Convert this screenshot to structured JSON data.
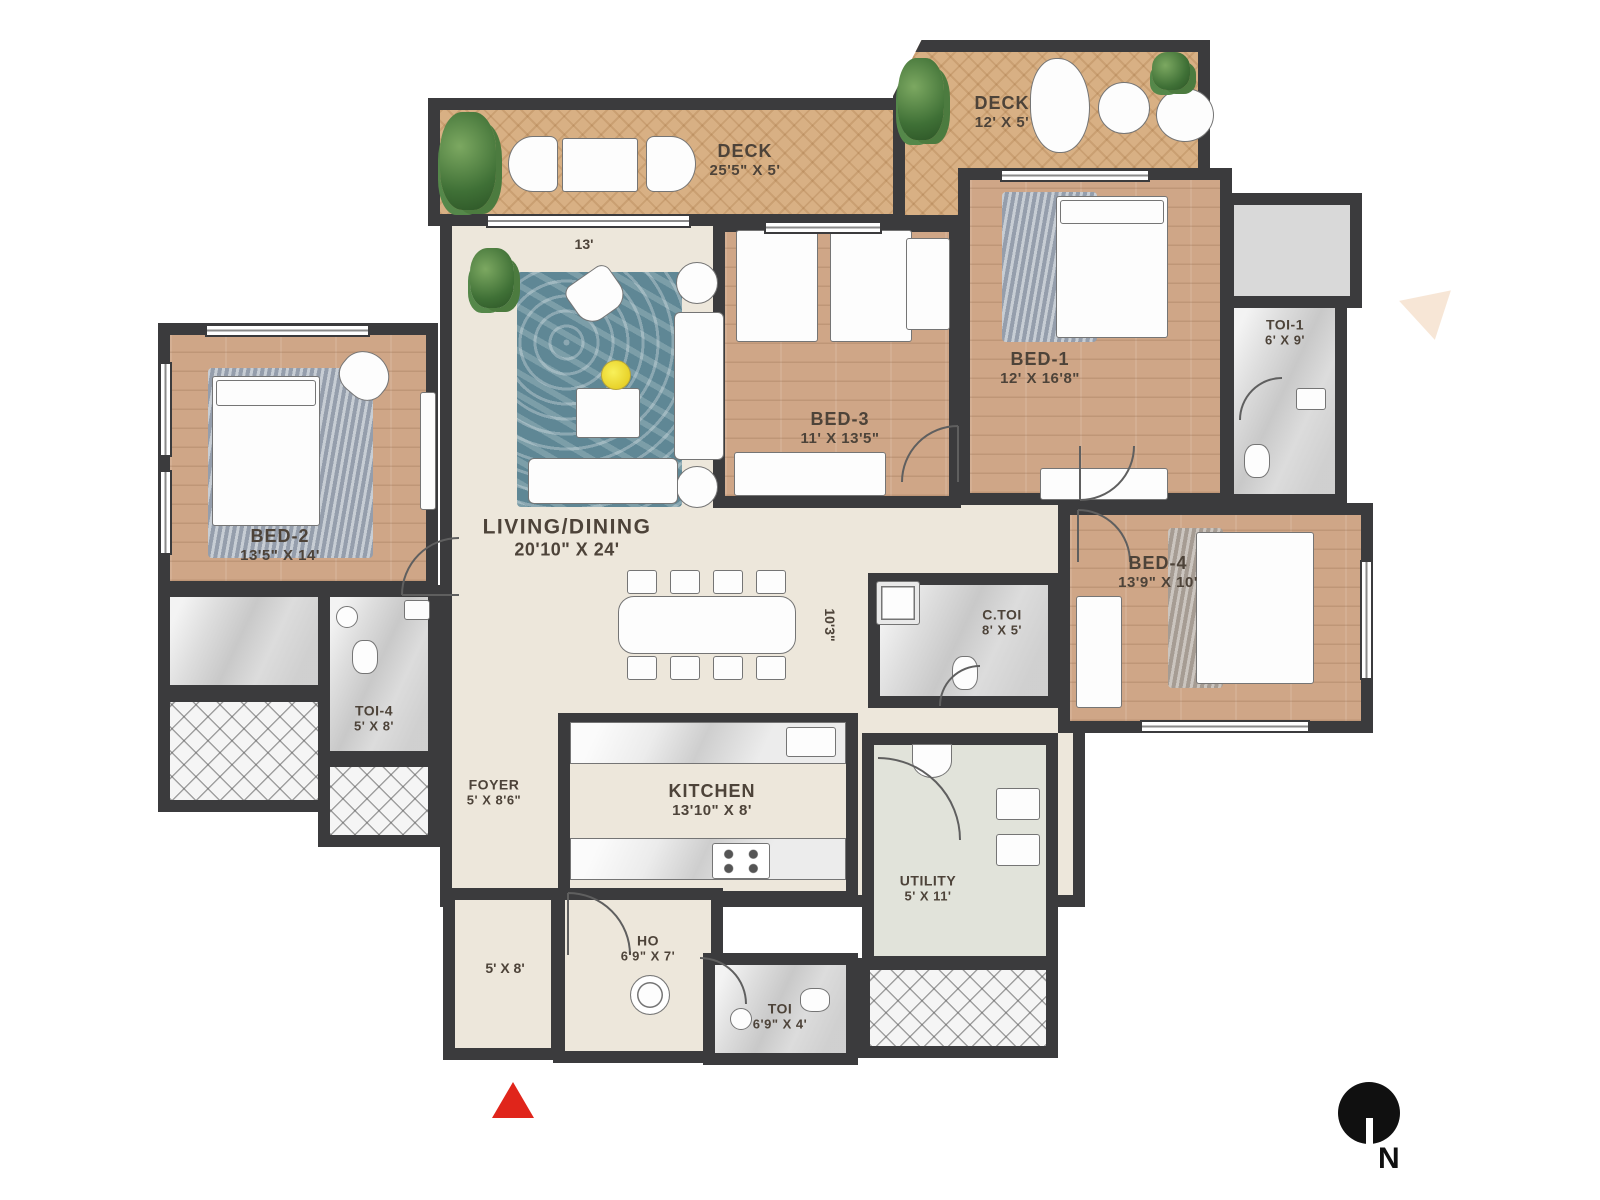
{
  "plan": {
    "rooms": {
      "deck_main": {
        "name": "DECK",
        "dims": "25'5\" X 5'"
      },
      "deck_2": {
        "name": "DECK",
        "dims": "12' X 5'"
      },
      "living": {
        "name": "LIVING/DINING",
        "dims": "20'10\" X 24'"
      },
      "bed1": {
        "name": "BED-1",
        "dims": "12' X 16'8\""
      },
      "toi1": {
        "name": "TOI-1",
        "dims": "6' X 9'"
      },
      "bed3": {
        "name": "BED-3",
        "dims": "11' X 13'5\""
      },
      "bed2": {
        "name": "BED-2",
        "dims": "13'5\" X 14'"
      },
      "toi4": {
        "name": "TOI-4",
        "dims": "5' X 8'"
      },
      "bed4": {
        "name": "BED-4",
        "dims": "13'9\" X 10'"
      },
      "ctoi": {
        "name": "C.TOI",
        "dims": "8' X 5'"
      },
      "kitchen": {
        "name": "KITCHEN",
        "dims": "13'10\" X 8'"
      },
      "utility": {
        "name": "UTILITY",
        "dims": "5' X 11'"
      },
      "foyer": {
        "name": "FOYER",
        "dims": "5' X 8'6\""
      },
      "ho": {
        "name": "HO",
        "dims": "6'9\" X 7'"
      },
      "toi": {
        "name": "TOI",
        "dims": "6'9\" X 4'"
      }
    },
    "annotations": {
      "living_width": "13'",
      "dining_length": "10'3\"",
      "entry_size": "5' X 8'"
    },
    "compass": {
      "label": "N"
    },
    "colors": {
      "wall": "#3b3b3d",
      "living_floor": "#ede7db",
      "wood_floor": "#cfa687",
      "deck_floor": "#d8b084",
      "bath_floor": "#dcdcdc",
      "utility_floor": "#e1e3da",
      "rug": "#5f8795",
      "entry_marker": "#e0251b"
    }
  }
}
